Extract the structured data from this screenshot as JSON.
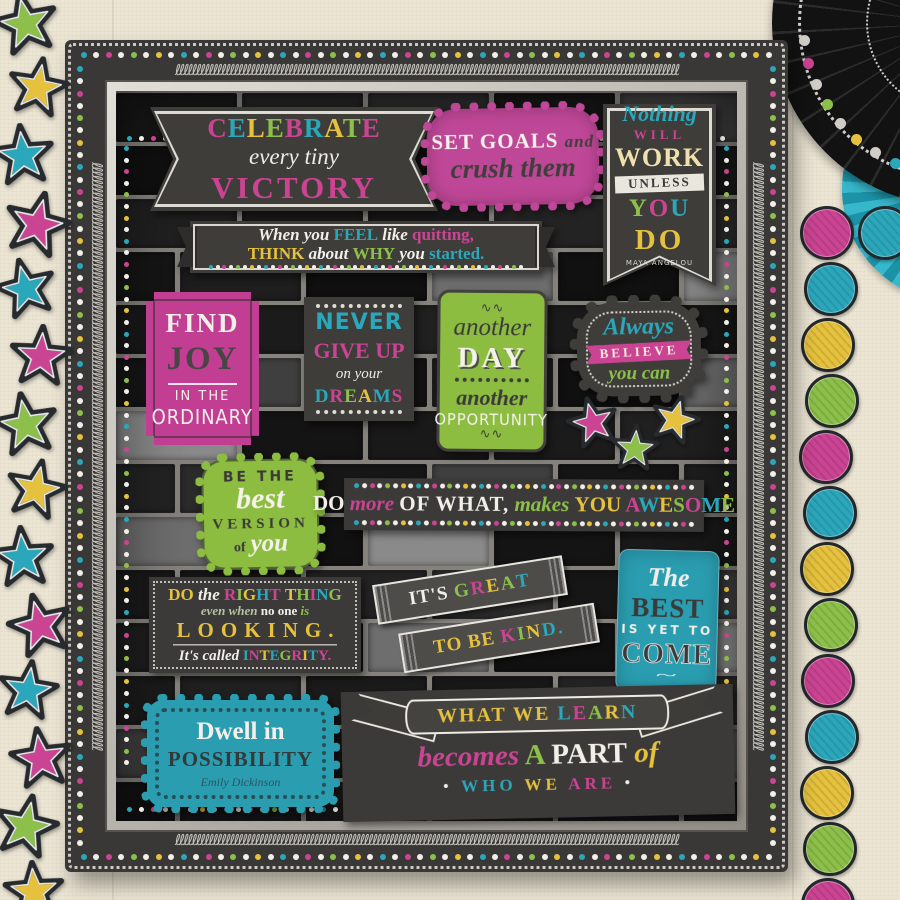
{
  "palette": {
    "pink": "#cb4493",
    "teal": "#2ba7bb",
    "yellow": "#e5c13d",
    "green": "#8dc04a",
    "white": "#f1efe8",
    "cream": "#efe0ae",
    "dark": "#454545",
    "sage": "#b6c0a4",
    "silver": "#cfcdc6",
    "pinkbg": "#bf4797",
    "greenbg": "#8cbd41",
    "tealbg": "#2a9db0",
    "darkbg": "#3b3a38",
    "wallbg": "#ece5d4",
    "brick": "#191919",
    "mortar": "#85827c"
  },
  "posters": {
    "celebrate": {
      "line1": [
        {
          "t": "C",
          "c": "pink"
        },
        {
          "t": "E",
          "c": "teal"
        },
        {
          "t": "L",
          "c": "yellow"
        },
        {
          "t": "E",
          "c": "green"
        },
        {
          "t": "B",
          "c": "pink"
        },
        {
          "t": "R",
          "c": "teal"
        },
        {
          "t": "A",
          "c": "yellow"
        },
        {
          "t": "T",
          "c": "green"
        },
        {
          "t": "E",
          "c": "pink"
        }
      ],
      "line2": "every tiny",
      "line3": "VICTORY"
    },
    "set_goals": {
      "line1": "SET GOALS",
      "conj": "and",
      "line2": "crush them"
    },
    "nothing_works": {
      "line1": "Nothing",
      "line2": "WILL",
      "line3": "WORK",
      "ribbon": "UNLESS",
      "line5": [
        {
          "t": "Y",
          "c": "green",
          "s": "slab"
        },
        {
          "t": "O",
          "c": "pink",
          "s": "slab"
        },
        {
          "t": "U",
          "c": "teal",
          "s": "slab"
        }
      ],
      "line6": "DO",
      "author": "MAYA ANGELOU"
    },
    "quitting": {
      "line1": [
        {
          "t": "When you ",
          "c": "white",
          "s": "script"
        },
        {
          "t": "FEEL",
          "c": "teal",
          "s": "slab"
        },
        {
          "t": " like ",
          "c": "white",
          "s": "script"
        },
        {
          "t": "quitting,",
          "c": "pink",
          "s": "slab"
        }
      ],
      "line2": [
        {
          "t": "THINK",
          "c": "yellow",
          "s": "slab"
        },
        {
          "t": " about ",
          "c": "white",
          "s": "script"
        },
        {
          "t": "WHY",
          "c": "green",
          "s": "slab"
        },
        {
          "t": " you ",
          "c": "white",
          "s": "script"
        },
        {
          "t": "started.",
          "c": "teal",
          "s": "slab"
        }
      ]
    },
    "find_joy": {
      "line1": "FIND",
      "line2": "JOY",
      "line3": "IN THE",
      "line4": "ORDINARY"
    },
    "never_give_up": {
      "line1": "NEVER",
      "line2": "GIVE UP",
      "line3": "on your",
      "line4": [
        {
          "t": "D",
          "c": "teal"
        },
        {
          "t": "R",
          "c": "pink"
        },
        {
          "t": "E",
          "c": "green"
        },
        {
          "t": "A",
          "c": "yellow"
        },
        {
          "t": "M",
          "c": "teal"
        },
        {
          "t": "S",
          "c": "pink"
        }
      ]
    },
    "another_day": {
      "ornament": "ee",
      "line1": "another",
      "line2": "DAY",
      "line3": "another",
      "line4": "OPPORTUNITY"
    },
    "always_believe": {
      "line1": "Always",
      "line2": "BELIEVE",
      "line3": "you can"
    },
    "best_version": {
      "line1": "BE THE",
      "line2": "best",
      "line3": "VERSION",
      "line4": "of",
      "line5": "you"
    },
    "do_more": {
      "line": [
        {
          "t": "DO",
          "c": "white",
          "s": "slab"
        },
        {
          "t": " more ",
          "c": "pink",
          "s": "script"
        },
        {
          "t": "OF WHAT,",
          "c": "white",
          "s": "caps"
        },
        {
          "t": " makes ",
          "c": "green",
          "s": "script"
        },
        {
          "t": "YOU ",
          "c": "yellow",
          "s": "slab"
        },
        {
          "t": "A",
          "c": "pink",
          "s": "slab"
        },
        {
          "t": "W",
          "c": "teal",
          "s": "slab"
        },
        {
          "t": "E",
          "c": "yellow",
          "s": "slab"
        },
        {
          "t": "S",
          "c": "green",
          "s": "slab"
        },
        {
          "t": "O",
          "c": "pink",
          "s": "slab"
        },
        {
          "t": "M",
          "c": "teal",
          "s": "slab"
        },
        {
          "t": "E",
          "c": "green",
          "s": "slab"
        }
      ]
    },
    "right_thing": {
      "line1": [
        {
          "t": "DO ",
          "c": "yellow",
          "s": "slab"
        },
        {
          "t": "the ",
          "c": "white",
          "s": "script"
        },
        {
          "t": "R",
          "c": "pink",
          "s": "slab"
        },
        {
          "t": "I",
          "c": "green",
          "s": "slab"
        },
        {
          "t": "G",
          "c": "yellow",
          "s": "slab"
        },
        {
          "t": "H",
          "c": "teal",
          "s": "slab"
        },
        {
          "t": "T",
          "c": "pink",
          "s": "slab"
        },
        {
          "t": " ",
          "c": "white"
        },
        {
          "t": "T",
          "c": "yellow",
          "s": "slab"
        },
        {
          "t": "H",
          "c": "green",
          "s": "slab"
        },
        {
          "t": "I",
          "c": "pink",
          "s": "slab"
        },
        {
          "t": "N",
          "c": "teal",
          "s": "slab"
        },
        {
          "t": "G",
          "c": "green",
          "s": "slab"
        }
      ],
      "line2": [
        {
          "t": "even when ",
          "c": "sage",
          "s": "script"
        },
        {
          "t": "no one ",
          "c": "white",
          "s": "slab"
        },
        {
          "t": "is",
          "c": "green",
          "s": "script"
        }
      ],
      "line3": "LOOKING.",
      "line4": [
        {
          "t": "It's called ",
          "c": "white",
          "s": "script"
        },
        {
          "t": "I",
          "c": "teal",
          "s": "slab"
        },
        {
          "t": "N",
          "c": "pink",
          "s": "slab"
        },
        {
          "t": "T",
          "c": "yellow",
          "s": "slab"
        },
        {
          "t": "E",
          "c": "teal",
          "s": "slab"
        },
        {
          "t": "G",
          "c": "green",
          "s": "slab"
        },
        {
          "t": "R",
          "c": "pink",
          "s": "slab"
        },
        {
          "t": "I",
          "c": "yellow",
          "s": "slab"
        },
        {
          "t": "T",
          "c": "teal",
          "s": "slab"
        },
        {
          "t": "Y.",
          "c": "pink",
          "s": "slab"
        }
      ]
    },
    "kind": {
      "band1": [
        {
          "t": "IT'S ",
          "c": "white",
          "s": "caps"
        },
        {
          "t": "G",
          "c": "green",
          "s": "slab"
        },
        {
          "t": "R",
          "c": "pink",
          "s": "slab"
        },
        {
          "t": "E",
          "c": "yellow",
          "s": "slab"
        },
        {
          "t": "A",
          "c": "green",
          "s": "slab"
        },
        {
          "t": "T",
          "c": "teal",
          "s": "slab"
        }
      ],
      "band2": [
        {
          "t": "TO BE ",
          "c": "yellow",
          "s": "caps"
        },
        {
          "t": "K",
          "c": "pink",
          "s": "slab"
        },
        {
          "t": "I",
          "c": "green",
          "s": "slab"
        },
        {
          "t": "N",
          "c": "yellow",
          "s": "slab"
        },
        {
          "t": "D.",
          "c": "teal",
          "s": "slab"
        }
      ]
    },
    "the_best": {
      "line1": "The",
      "line2": "BEST",
      "line3": "IS YET TO",
      "line4": "COME",
      "ornament": "~"
    },
    "dwell": {
      "line1": "Dwell in",
      "line2": "POSSIBILITY",
      "author": "Emily Dickinson"
    },
    "learn": {
      "ribbon": [
        {
          "t": "WHAT WE ",
          "c": "yellow",
          "s": "slab"
        },
        {
          "t": "L",
          "c": "teal",
          "s": "slab"
        },
        {
          "t": "E",
          "c": "pink",
          "s": "slab"
        },
        {
          "t": "A",
          "c": "green",
          "s": "slab"
        },
        {
          "t": "R",
          "c": "yellow",
          "s": "slab"
        },
        {
          "t": "N",
          "c": "teal",
          "s": "slab"
        }
      ],
      "line2": [
        {
          "t": "becomes",
          "c": "pink",
          "s": "script"
        },
        {
          "t": " A ",
          "c": "green",
          "s": "slab"
        },
        {
          "t": "PART",
          "c": "white",
          "s": "slab"
        },
        {
          "t": " of",
          "c": "yellow",
          "s": "script"
        }
      ],
      "line3": [
        {
          "t": "• ",
          "c": "white"
        },
        {
          "t": "WHO ",
          "c": "teal",
          "s": "slab"
        },
        {
          "t": "WE ",
          "c": "yellow",
          "s": "slab"
        },
        {
          "t": "ARE",
          "c": "pink",
          "s": "slab"
        },
        {
          "t": " •",
          "c": "white"
        }
      ]
    }
  },
  "decor": {
    "frame_dot_colors": [
      "teal",
      "white",
      "pink",
      "white",
      "green",
      "white",
      "yellow",
      "white"
    ],
    "rosette_dot_colors": [
      "pink",
      "silver",
      "teal",
      "silver",
      "yellow",
      "silver",
      "green",
      "silver",
      "pink",
      "silver"
    ],
    "left_stars": [
      {
        "x": -8,
        "y": -10,
        "c": "green",
        "rot": -12,
        "s": 68
      },
      {
        "x": 6,
        "y": 56,
        "c": "yellow",
        "rot": 10,
        "s": 64
      },
      {
        "x": -10,
        "y": 123,
        "c": "teal",
        "rot": -6,
        "s": 66
      },
      {
        "x": 2,
        "y": 190,
        "c": "pink",
        "rot": 14,
        "s": 70
      },
      {
        "x": -6,
        "y": 257,
        "c": "teal",
        "rot": -14,
        "s": 64
      },
      {
        "x": 8,
        "y": 324,
        "c": "pink",
        "rot": 4,
        "s": 66
      },
      {
        "x": -8,
        "y": 391,
        "c": "green",
        "rot": -10,
        "s": 68
      },
      {
        "x": 4,
        "y": 458,
        "c": "yellow",
        "rot": 12,
        "s": 64
      },
      {
        "x": -10,
        "y": 525,
        "c": "teal",
        "rot": -5,
        "s": 66
      },
      {
        "x": 6,
        "y": 592,
        "c": "pink",
        "rot": -14,
        "s": 68
      },
      {
        "x": -4,
        "y": 659,
        "c": "teal",
        "rot": 8,
        "s": 64
      },
      {
        "x": 8,
        "y": 726,
        "c": "pink",
        "rot": -8,
        "s": 66
      },
      {
        "x": -8,
        "y": 793,
        "c": "green",
        "rot": 12,
        "s": 68
      },
      {
        "x": 2,
        "y": 860,
        "c": "yellow",
        "rot": -4,
        "s": 64
      }
    ],
    "scatter_stars": [
      {
        "x": 566,
        "y": 396,
        "c": "pink",
        "rot": -14,
        "s": 54
      },
      {
        "x": 610,
        "y": 424,
        "c": "green",
        "rot": 4,
        "s": 50
      },
      {
        "x": 649,
        "y": 394,
        "c": "yellow",
        "rot": 16,
        "s": 52
      }
    ],
    "right_circles": [
      {
        "x": 800,
        "y": 206,
        "c": "pink"
      },
      {
        "x": 804,
        "y": 262,
        "c": "teal"
      },
      {
        "x": 801,
        "y": 318,
        "c": "yellow"
      },
      {
        "x": 805,
        "y": 374,
        "c": "green"
      },
      {
        "x": 799,
        "y": 430,
        "c": "pink"
      },
      {
        "x": 803,
        "y": 486,
        "c": "teal"
      },
      {
        "x": 800,
        "y": 542,
        "c": "yellow"
      },
      {
        "x": 804,
        "y": 598,
        "c": "green"
      },
      {
        "x": 801,
        "y": 654,
        "c": "pink"
      },
      {
        "x": 805,
        "y": 710,
        "c": "teal"
      },
      {
        "x": 800,
        "y": 766,
        "c": "yellow"
      },
      {
        "x": 803,
        "y": 822,
        "c": "green"
      },
      {
        "x": 801,
        "y": 878,
        "c": "pink"
      }
    ],
    "corner_circle": {
      "x": 858,
      "y": 206,
      "c": "teal"
    }
  }
}
